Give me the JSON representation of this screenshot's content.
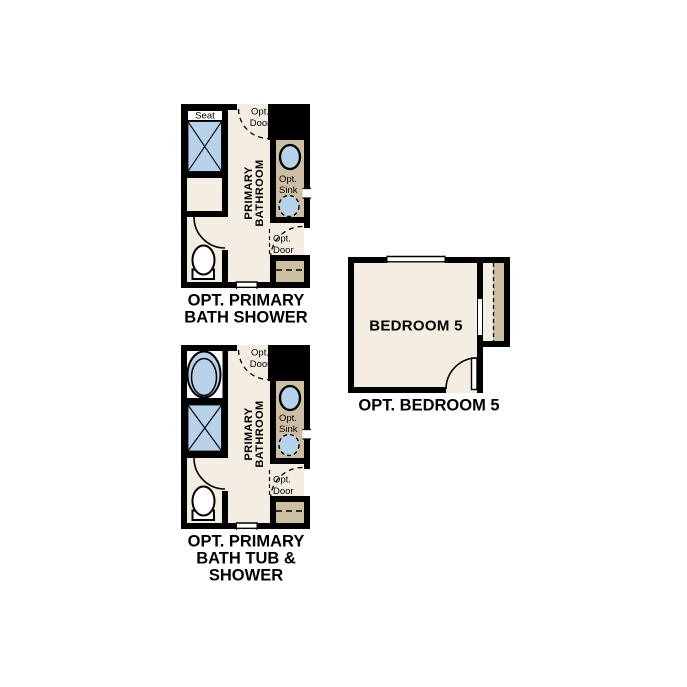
{
  "colors": {
    "background": "#FFFFFF",
    "wall": "#000000",
    "floor": "#F3EEE1",
    "counter": "#CCBEA3",
    "fixture": "#B8D2EB",
    "text": "#000000"
  },
  "plans": {
    "bath_shower": {
      "caption": {
        "line1": "OPT. PRIMARY",
        "line2": "BATH SHOWER"
      },
      "room_label": {
        "line1": "PRIMARY",
        "line2": "BATHROOM"
      },
      "labels": {
        "seat": "Seat",
        "opt_door_top": {
          "line1": "Opt.",
          "line2": "Door"
        },
        "opt_sink": {
          "line1": "Opt.",
          "line2": "Sink"
        },
        "opt_door_bottom": {
          "line1": "Opt.",
          "line2": "Door"
        }
      }
    },
    "bath_tub_shower": {
      "caption": {
        "line1": "OPT. PRIMARY",
        "line2": "BATH TUB &",
        "line3": "SHOWER"
      },
      "room_label": {
        "line1": "PRIMARY",
        "line2": "BATHROOM"
      },
      "labels": {
        "opt_door_top": {
          "line1": "Opt.",
          "line2": "Door"
        },
        "opt_sink": {
          "line1": "Opt.",
          "line2": "Sink"
        },
        "opt_door_bottom": {
          "line1": "Opt.",
          "line2": "Door"
        }
      }
    },
    "bedroom5": {
      "caption": "OPT. BEDROOM 5",
      "room_label": "BEDROOM 5"
    }
  }
}
